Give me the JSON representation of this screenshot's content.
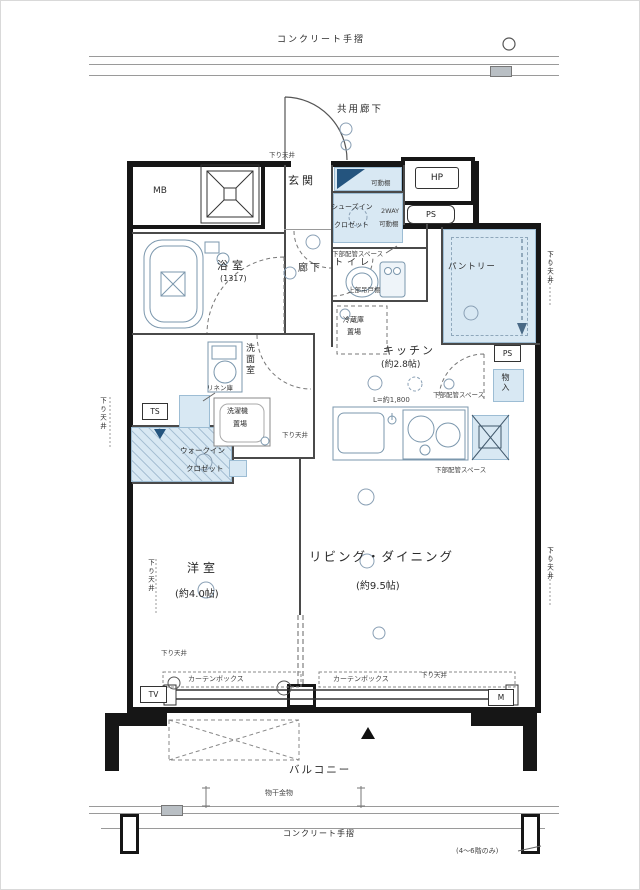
{
  "colors": {
    "wall": "#161616",
    "accent_fill": "#d8e8f3",
    "fixture_line": "#7b97ad",
    "accent_navy": "#24547e"
  },
  "exterior": {
    "handrail_top": "コンクリート手摺",
    "handrail_bottom": "コンクリート手摺",
    "common_corridor": "共用廊下",
    "balcony": "バルコニー",
    "laundry_fitting": "物干金物",
    "floor_note": "(4〜6階のみ)"
  },
  "labels": {
    "lowered_ceiling": "下り天井",
    "curtain_box": "カーテンボックス",
    "pipe_space_lower": "下部配管スペース",
    "movable_shelf": "可動棚",
    "two_way": "2WAY",
    "upper_cabinet": "上部吊戸棚",
    "linen": "リネン庫",
    "counter_length": "L=約1,800",
    "tv": "TV",
    "m": "M",
    "ts": "TS",
    "ps": "PS",
    "hp": "HP",
    "mb": "MB"
  },
  "rooms": {
    "entrance": "玄関",
    "corridor": "廊下",
    "bathroom": "浴室",
    "bathroom_size": "(1317)",
    "washroom": "洗面室",
    "laundry_l1": "洗濯機",
    "laundry_l2": "置場",
    "toilet": "トイレ",
    "sic_l1": "シューズイン",
    "sic_l2": "クロゼット",
    "pantry": "パントリー",
    "kitchen": "キッチン",
    "kitchen_size": "(約2.8帖)",
    "fridge_l1": "冷蔵庫",
    "fridge_l2": "置場",
    "storage": "物入",
    "wic_l1": "ウォークイン",
    "wic_l2": "クロゼット",
    "bedroom": "洋室",
    "bedroom_size": "(約4.0帖)",
    "living": "リビング・ダイニング",
    "living_size": "(約9.5帖)"
  }
}
